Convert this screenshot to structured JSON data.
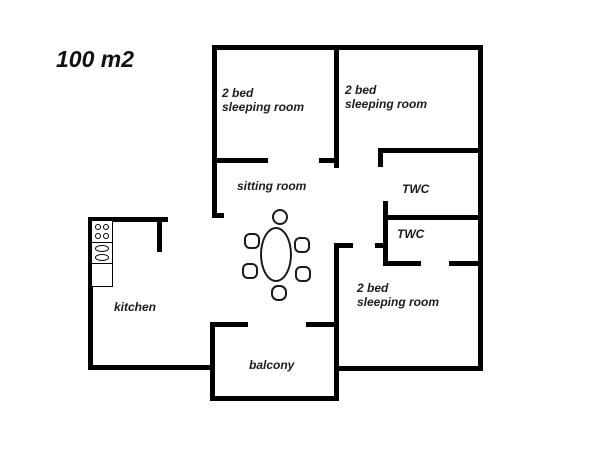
{
  "plan": {
    "area_label": "100 m2",
    "rooms": {
      "bedroom_top_left": {
        "l1": "2 bed",
        "l2": "sleeping room"
      },
      "bedroom_top_right": {
        "l1": "2 bed",
        "l2": "sleeping room"
      },
      "bedroom_bottom_right": {
        "l1": "2 bed",
        "l2": "sleeping room"
      },
      "sitting_room": {
        "label": "sitting room"
      },
      "twc_upper": {
        "label": "TWC"
      },
      "twc_lower": {
        "label": "TWC"
      },
      "kitchen": {
        "label": "kitchen"
      },
      "balcony": {
        "label": "balcony"
      }
    },
    "furniture": {
      "dining_table": "oval dining table",
      "chairs": 6,
      "stove_burners": 4,
      "sink_basins": 2
    },
    "colors": {
      "wall": "#000000",
      "background": "#ffffff",
      "text": "#1c1c1c"
    }
  }
}
